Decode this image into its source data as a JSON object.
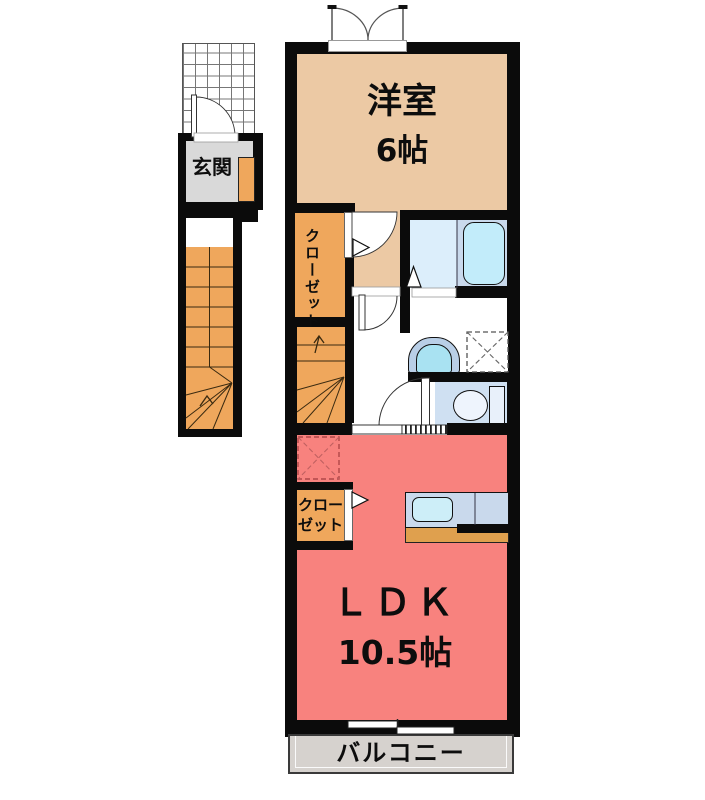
{
  "rooms": {
    "bedroom": {
      "name": "洋室",
      "size": "6帖"
    },
    "entrance": {
      "name": "玄関"
    },
    "closet_upper": {
      "name": "クローゼット"
    },
    "closet_lower": {
      "line1": "クロー",
      "line2": "ゼット"
    },
    "ldk": {
      "name": "ＬＤＫ",
      "size": "10.5帖"
    },
    "balcony": {
      "name": "バルコニー"
    }
  },
  "fixtures": [
    "entrance-porch",
    "entrance-door",
    "staircase-lower",
    "staircase-upper",
    "shoe-cabinet",
    "bathtub",
    "bath-folding-door",
    "washbasin",
    "washing-machine-space",
    "toilet",
    "refrigerator-space",
    "kitchen-counter",
    "kitchen-sink",
    "sliding-door",
    "balcony-window",
    "casement-window"
  ],
  "colors": {
    "bedroom": "#ecc9a4",
    "ldk_pink": "#f8827e",
    "stairs_orange": "#efa75c",
    "bath_floor": "#dceefb",
    "bathtub": "#c2ecfa",
    "counter_blue": "#c9d9ec",
    "counter_edge_orange": "#dfa04e",
    "toilet_floor": "#cfe0f2",
    "entrance_floor": "#d9d9d9",
    "balcony_gray": "#d6d2ce",
    "wall_black": "#0b0b0b"
  }
}
